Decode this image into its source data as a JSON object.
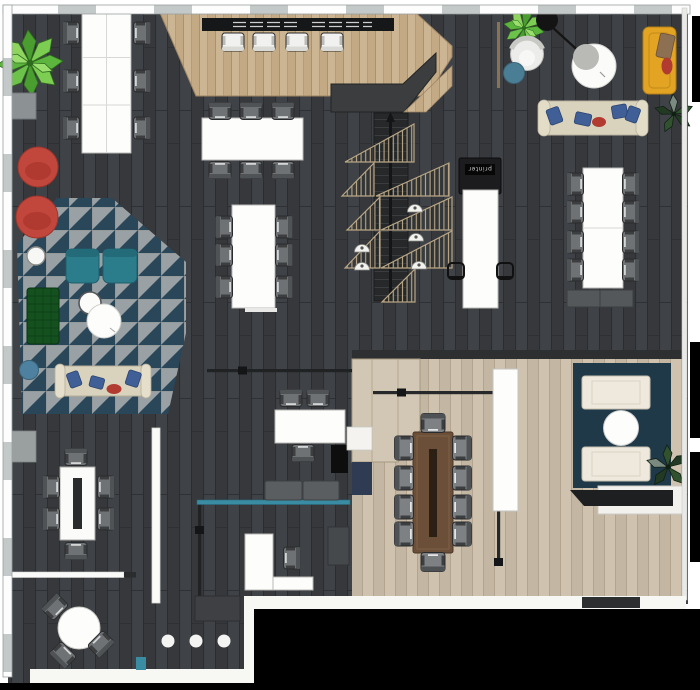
{
  "labels": {
    "printer": "printer"
  },
  "colors": {
    "floor_dark": "#3a3c3f",
    "floor_beige": "#c8bca9",
    "platform_wood": "#cbb391",
    "rug_gray": "#9aa1a4",
    "rug_navy": "#2a4659",
    "lounge_rug_navy": "#1f3949",
    "armchair_teal": "#2c7d8c",
    "pouf_red": "#c1473c",
    "sofa_green": "#14511f",
    "sofa_yellow": "#e3a424",
    "sofa_cream": "#d9d2bc",
    "accent_teal_wall": "#3a8ca3",
    "conference_table_wood": "#6b4f39",
    "plant_green": "#5cb53c",
    "trellis_tan": "#b9a685"
  },
  "areas": [
    {
      "name": "open-office",
      "items": "6-seat tables x3, 8-seat table, printer station, trellis staircase"
    },
    {
      "name": "lounge",
      "items": "triangle-pattern rug, teal armchairs x2, green sofa, cream sofas x2, red poufs x2, round side tables"
    },
    {
      "name": "meeting-room",
      "items": "10-seat wood table, white panel, navy rug, cream sofas x2, round coffee table, console"
    },
    {
      "name": "reception",
      "items": "reception desk, L-desk, teal partition, gray bench"
    },
    {
      "name": "cafe-corner",
      "items": "round table with 3 chairs, bar stools x3"
    }
  ]
}
